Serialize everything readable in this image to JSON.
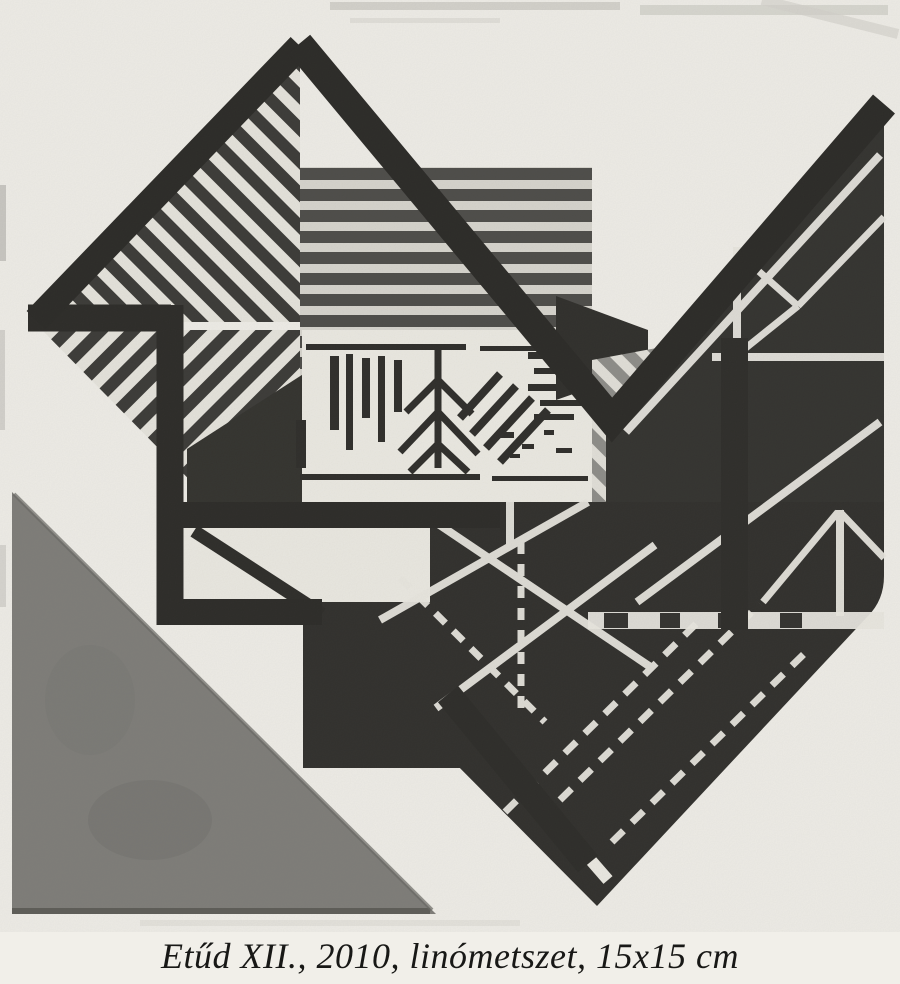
{
  "page": {
    "kind": "art catalog page with linocut reproduction",
    "background_color": "#f1efe9"
  },
  "artwork": {
    "description": "abstract geometric black-and-gray linocut print: striped diamond, triangulated triangles, meander line, gray corner triangle",
    "caption": {
      "full": "Etűd XII., 2010, linómetszet, 15x15 cm",
      "title": "Etűd XII.",
      "year": "2010",
      "technique": "linómetszet",
      "size": "15x15 cm"
    },
    "palette": {
      "paper": "#f1efe9",
      "ink": "#2b2a27",
      "stripe_dark": "#4e4d4a",
      "stripe_light": "#d8d6cf",
      "gray_triangle": "#7f7e7a",
      "band_gray": "#8f8e8a",
      "white_line": "#eae8e1"
    }
  }
}
